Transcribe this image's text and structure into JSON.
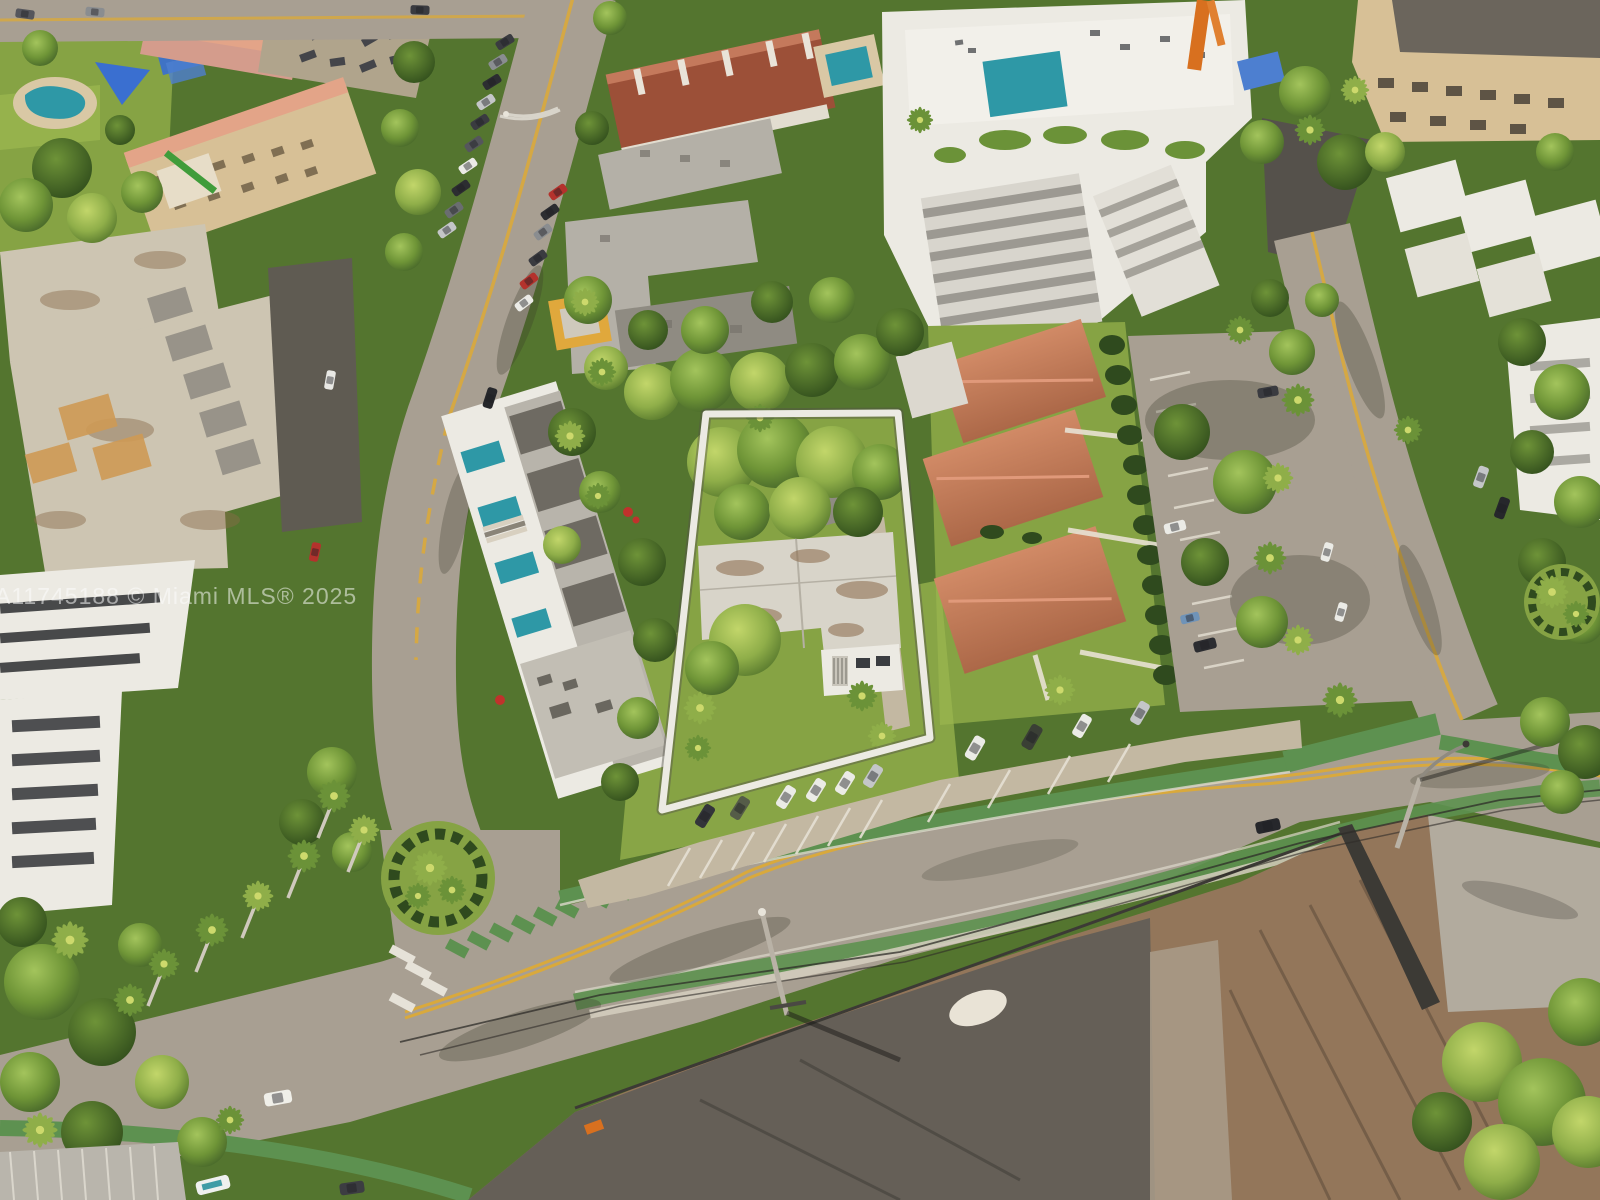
{
  "photo": {
    "kind": "aerial-drone-photograph",
    "description": "Oblique aerial view of a Miami residential block. A vacant-style lot with a flat-roof duplex and dense trees is highlighted by a white boundary outline. Surroundings: modern white condo buildings with rooftop pools, terracotta tile roofed cottages, a tan apartment block, tree-lined streets with green bike lanes, angled street parking, a surface parking lot, and a cleared dirt construction site across the main road."
  },
  "watermark": {
    "full_text": "A11745188 © Miami MLS® 2025",
    "mls_number": "A11745188",
    "source": "Miami MLS®",
    "year": "2025",
    "opacity": 0.52
  },
  "property_outline": {
    "stroke_color": "#ffffff",
    "stroke_width": 7,
    "points_str": "706,414 898,413 930,738 662,810"
  },
  "palette": {
    "vegDark": "#3b5524",
    "veg": "#54752f",
    "vegMid": "#6b9238",
    "vegBright": "#8fae49",
    "lawn": "#86a344",
    "lawnBright": "#9ab54f",
    "road": "#a89f92",
    "roadDark": "#938b7e",
    "bikeGreen": "#5d9150",
    "yellowLine": "#d9a93c",
    "dirt": "#93765a",
    "gravel": "#615d56",
    "gravelLight": "#a99c89",
    "sandPile": "#e9e3d6",
    "concretePad": "#b2ab9e",
    "terracotta": "#c07b5a",
    "terracottaLight": "#d18a66",
    "redRoof": "#9c5038",
    "beige": "#d7c096",
    "salmon": "#e3a488",
    "salmonBldg": "#d49c8c",
    "white": "#eceae3",
    "offWhite": "#dcd8cf",
    "agedConcrete": "#cdc5b2",
    "grayRoof": "#b4b0a7",
    "grayRoofDark": "#8f8b82",
    "pool": "#2e98a6",
    "poolDeck": "#d9c8a5",
    "tarpBlue": "#4d7fd0",
    "canopyBlue": "#3a6fd0",
    "craneOrange": "#d8701f",
    "carWhite": "#ebebe6",
    "carSilver": "#c4c6c8",
    "carDark": "#33343a",
    "carRed": "#b4322c",
    "carOlive": "#555c48",
    "wire": "#2e2c28",
    "fence": "#3c3a35",
    "stain": "#8a6a4a",
    "hedge": "#2f4a1e",
    "walk": "#d6cfbf",
    "pad": "#c3b8a2"
  },
  "scene": {
    "highlighted_lot": "trapezoid outline around treed lot with flat white roof building, carport, palms and front lawn",
    "regions": [
      "park with pool and blue shade canopies (top left)",
      "tan apartment building with salmon roof edge (upper left)",
      "aged white concrete apartment complex (left)",
      "modern white townhouse row with rooftop plunge pools (center left)",
      "red tile roof townhouse row (top center)",
      "white condo tower with rooftop pool deck (top center right)",
      "three terracotta roofed cottages (right of outlined lot)",
      "surface parking lot with cars (right)",
      "tan condo and white townhouses (top right)",
      "construction crane (top right)",
      "main road with green bike lanes and angled parked cars (bottom)",
      "cleared dirt construction site (bottom right)"
    ],
    "street_features": [
      "double yellow center lines",
      "green bike lanes",
      "green dashed bike crossing",
      "white crosswalk bars",
      "leaning utility poles with long shadows",
      "overhead wires"
    ]
  }
}
